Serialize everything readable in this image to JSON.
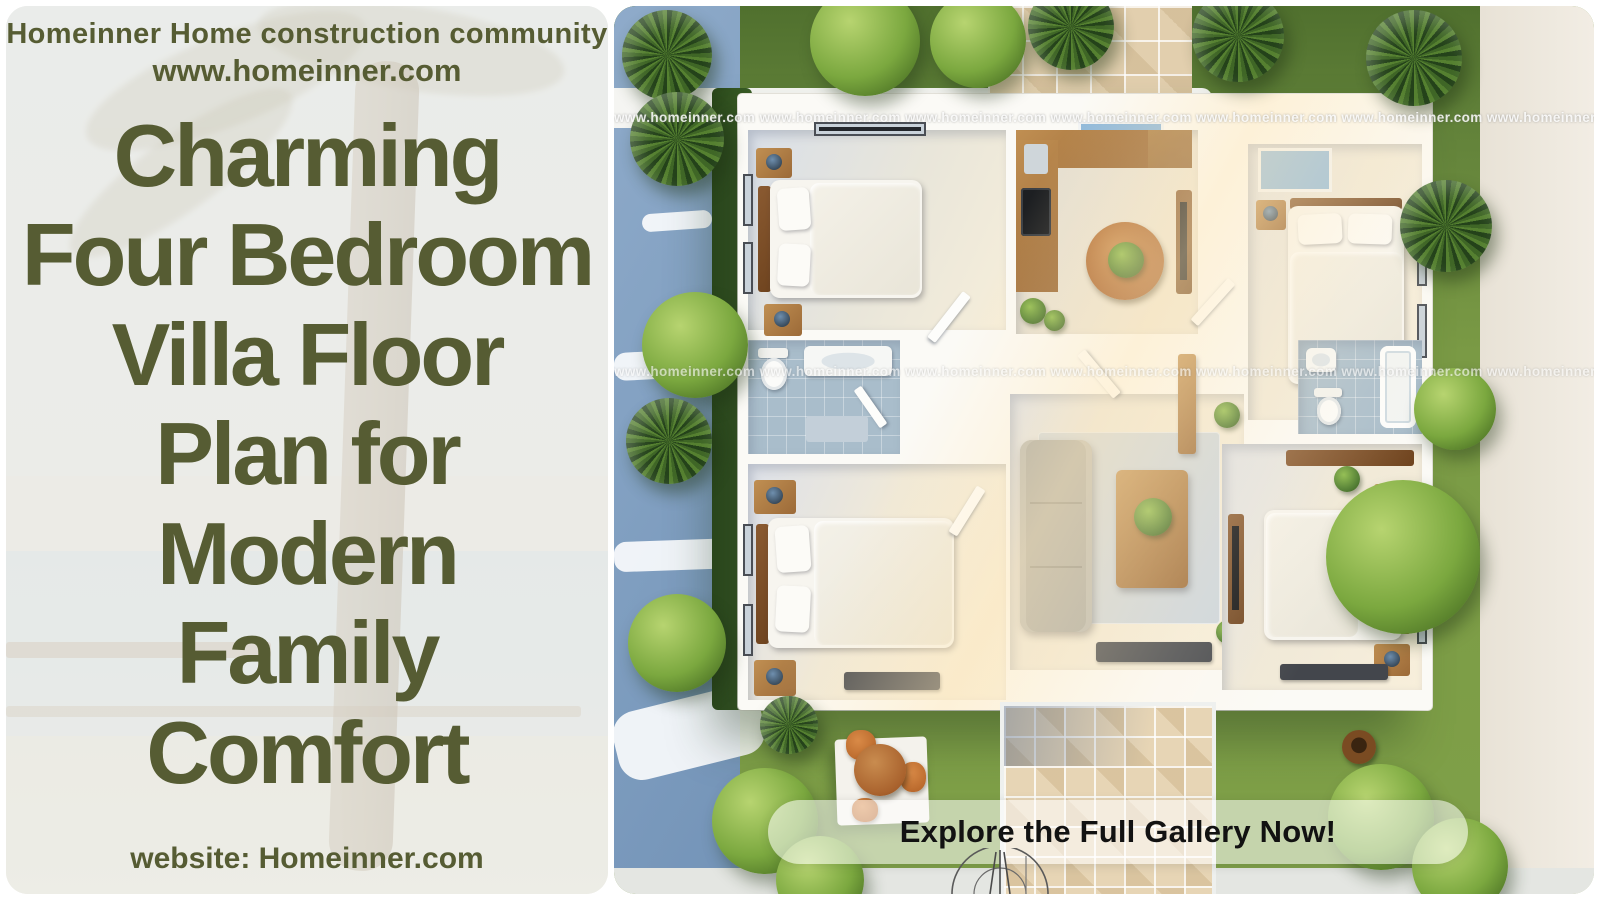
{
  "header": {
    "line1": "Homeinner Home construction community",
    "line2": "www.homeinner.com"
  },
  "title": {
    "lines": [
      "Charming",
      "Four Bedroom",
      "Villa Floor",
      "Plan for",
      "Modern",
      "Family",
      "Comfort"
    ]
  },
  "footer": {
    "label": "website: Homeinner.com"
  },
  "cta": {
    "label": "Explore the Full Gallery Now!"
  },
  "watermark": {
    "row": "www.homeinner.com www.homeinner.com www.homeinner.com www.homeinner.com www.homeinner.com www.homeinner.com www.homeinner.com www.homeinner.com www.homeinner.com"
  },
  "colors": {
    "olive_text": "#565c33",
    "lawn_green": "#7a9a45",
    "driveway_blue": "#8aa5c6",
    "walkway_beige": "#e7d5b5",
    "banner_bg": "rgba(255,255,255,0.55)",
    "banner_text": "#121212"
  }
}
